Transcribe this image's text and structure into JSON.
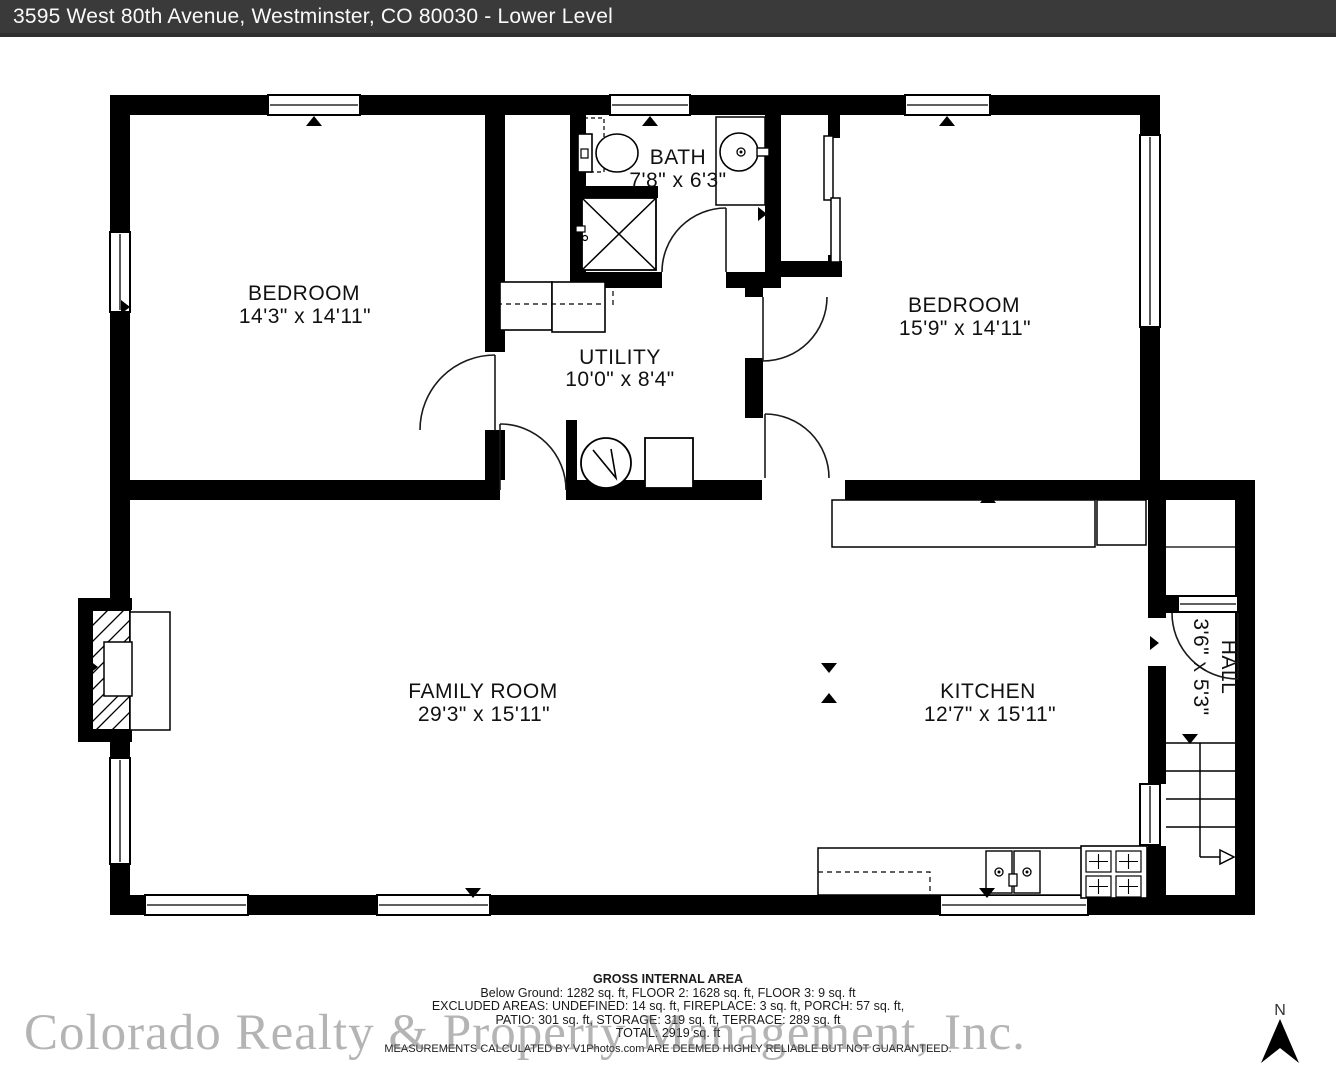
{
  "header": {
    "title": "3595 West 80th Avenue, Westminster, CO 80030 - Lower Level"
  },
  "rooms": {
    "bedroom_left": {
      "name": "BEDROOM",
      "dims": "14'3\" x 14'11\""
    },
    "bath": {
      "name": "BATH",
      "dims": "7'8\" x 6'3\""
    },
    "bedroom_right": {
      "name": "BEDROOM",
      "dims": "15'9\" x 14'11\""
    },
    "utility": {
      "name": "UTILITY",
      "dims": "10'0\" x 8'4\""
    },
    "family_room": {
      "name": "FAMILY ROOM",
      "dims": "29'3\" x 15'11\""
    },
    "kitchen": {
      "name": "KITCHEN",
      "dims": "12'7\" x 15'11\""
    },
    "hall": {
      "name": "HALL",
      "dims": "3'6\" x 5'3\""
    }
  },
  "footer": {
    "heading": "GROSS INTERNAL AREA",
    "floors": "Below Ground: 1282 sq. ft, FLOOR 2: 1628 sq. ft, FLOOR 3: 9 sq. ft",
    "excluded_1": "EXCLUDED AREAS: UNDEFINED: 14 sq. ft, FIREPLACE: 3 sq. ft, PORCH: 57 sq. ft,",
    "excluded_2": "PATIO: 301 sq. ft, STORAGE: 319 sq. ft, TERRACE: 289 sq. ft",
    "total": "TOTAL: 2919 sq. ft",
    "disclaimer": "MEASUREMENTS CALCULATED BY V1Photos.com ARE DEEMED HIGHLY RELIABLE BUT NOT GUARANTEED."
  },
  "watermark": "Colorado Realty & Property Management, Inc.",
  "compass": {
    "label": "N"
  },
  "colors": {
    "wall": "#000000",
    "header_bg": "#3a3a3a",
    "header_text": "#fafafa",
    "watermark_gray": "#696969"
  }
}
